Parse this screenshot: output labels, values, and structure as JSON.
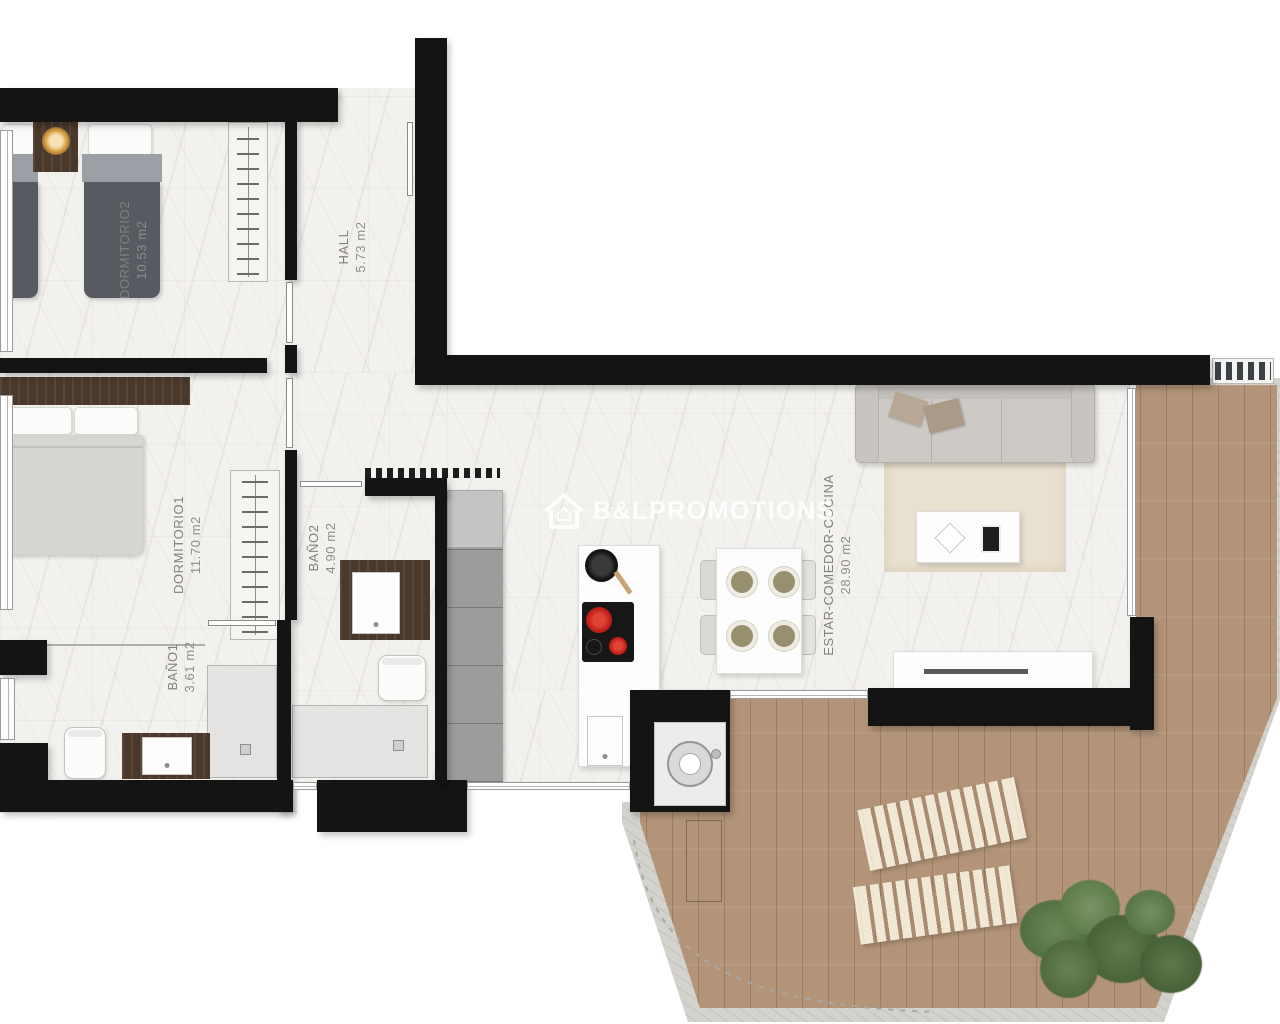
{
  "watermark": {
    "brand": "B&LPROMOTIONS"
  },
  "rooms": [
    {
      "name": "DORMITORIO2",
      "area": "10.53 m2"
    },
    {
      "name": "HALL",
      "area": "5.73 m2"
    },
    {
      "name": "DORMITORIO1",
      "area": "11.70 m2"
    },
    {
      "name": "BAÑO2",
      "area": "4.90 m2"
    },
    {
      "name": "BAÑO1",
      "area": "3.61 m2"
    },
    {
      "name": "ESTAR-COMEDOR-COCINA",
      "area": "28.90 m2"
    }
  ],
  "colors": {
    "wall": "#141414",
    "marble_floor": "#f3f1ee",
    "terrace_wood": "#b39478",
    "burner_red": "#c2201a",
    "lounger_cream": "#f0e7d5",
    "plant_green": "#5e7a4a"
  }
}
